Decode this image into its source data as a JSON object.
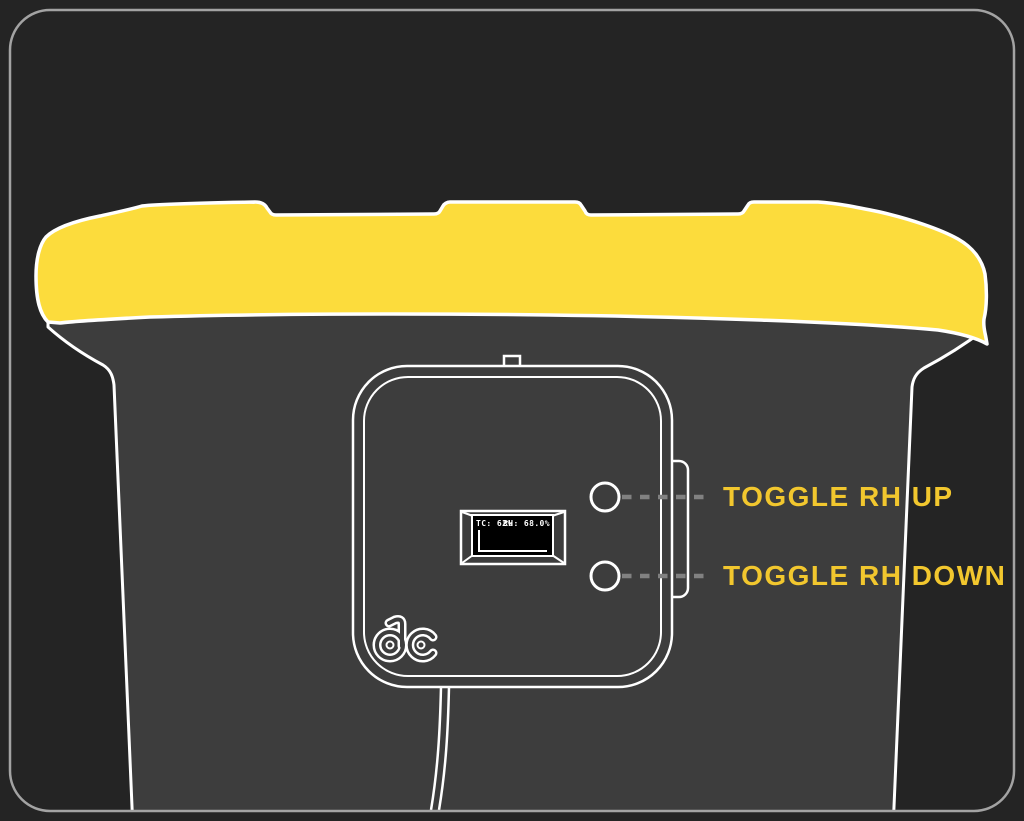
{
  "callouts": {
    "up": {
      "label": "TOGGLE RH UP"
    },
    "down": {
      "label": "TOGGLE RH DOWN"
    }
  },
  "display": {
    "tc_value": "TC: 62%",
    "rh_value": "RH: 68.0%"
  },
  "logo": {
    "text": "dc"
  },
  "colors": {
    "background": "#242424",
    "bin_gray": "#3D3D3D",
    "lid_yellow": "#FCDC3C",
    "label_yellow": "#F2C72E",
    "outline_white": "#FFFFFF",
    "dash_gray": "#818181",
    "border_gray": "#A3A3A3",
    "screen_black": "#000000"
  }
}
